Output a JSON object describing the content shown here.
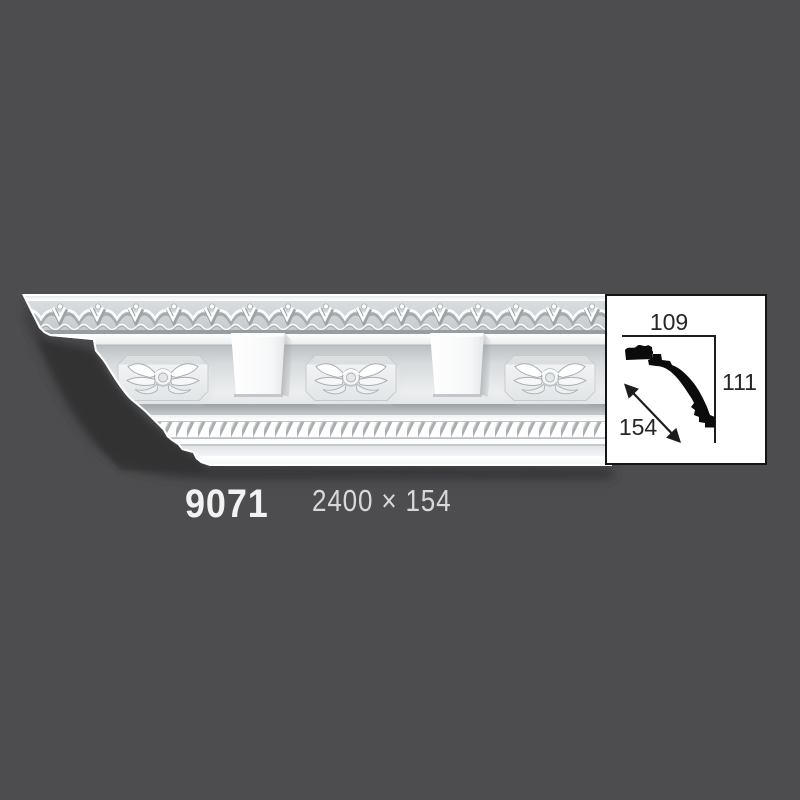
{
  "colors": {
    "background": "#4d4d4f",
    "box_border": "#151515",
    "box_background": "#ffffff",
    "diagram_ink": "#262626",
    "code_text": "#f2f2f2",
    "size_text": "#d8d8d8"
  },
  "photo": {
    "alt": "White ornamental crown moulding strip shown at an angle, with carved leaf frieze, floral rosette panels, modillion blocks and a rope-twist band, casting a shadow on a gray background"
  },
  "dimension_box": {
    "top_width": "109",
    "height": "111",
    "diagonal": "154"
  },
  "caption": {
    "code": "9071",
    "size": "2400 × 154"
  }
}
